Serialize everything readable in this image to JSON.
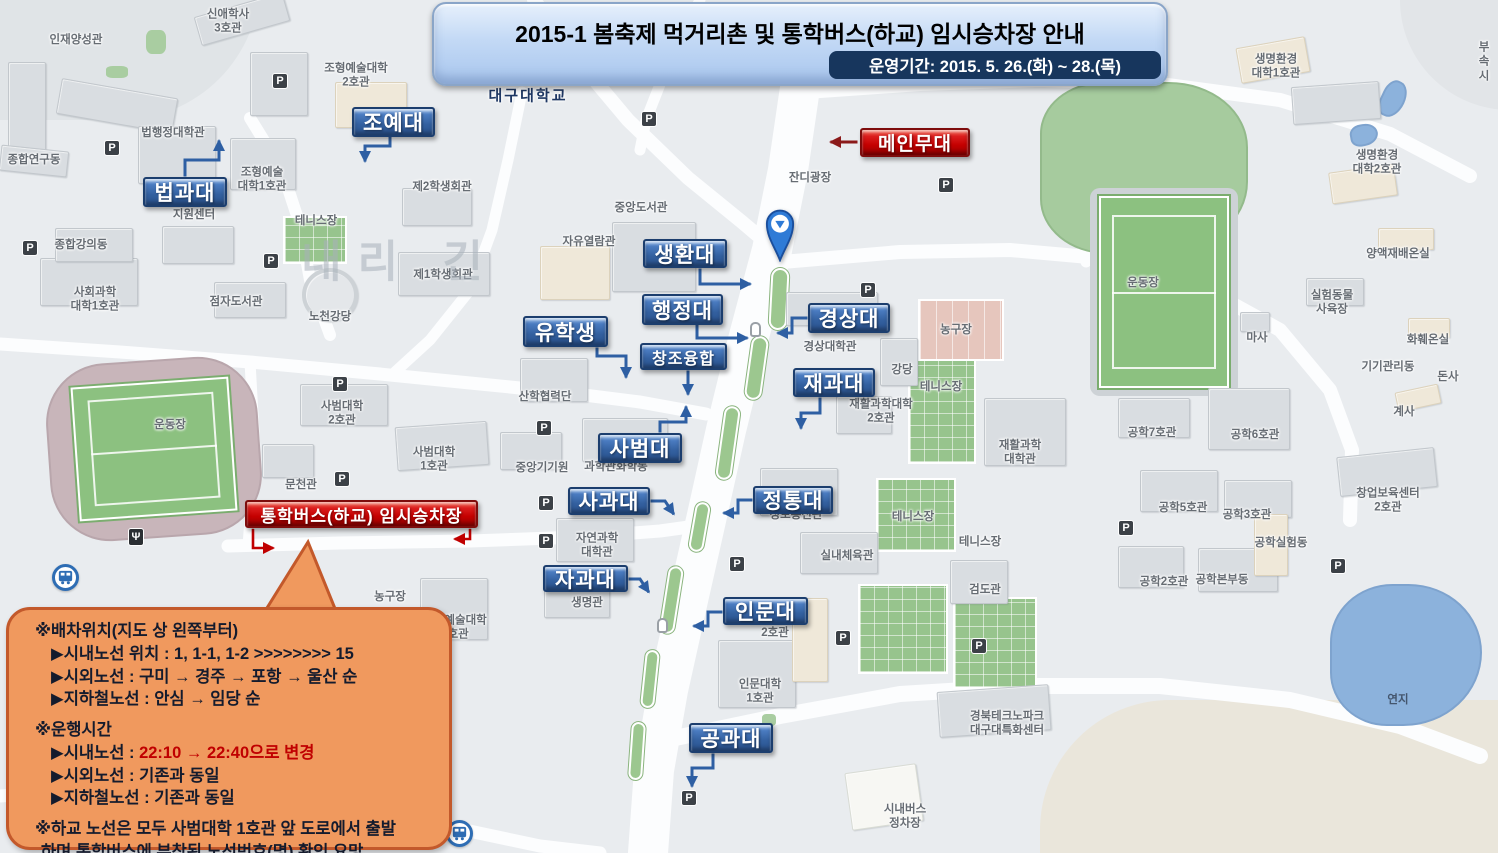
{
  "banner": {
    "title": "2015-1 봄축제 먹거리촌 및 통학버스(하교) 임시승차장 안내",
    "subtitle": "운영기간: 2015. 5. 26.(화) ~ 28.(목)"
  },
  "notice": {
    "lines": [
      {
        "t": "※배차위치(지도 상 왼쪽부터)",
        "ind": 0
      },
      {
        "t": "▶시내노선 위치 : 1, 1-1, 1-2 >>>>>>>> 15",
        "ind": 1
      },
      {
        "t": "▶시외노선 : 구미 → 경주 → 포항 → 울산 순",
        "ind": 1
      },
      {
        "t": "▶지하철노선 : 안심 → 임당 순",
        "ind": 1
      },
      {
        "t": "※운행시간",
        "ind": 0,
        "gap": 1
      },
      {
        "t": "▶시내노선 : ",
        "red": "22:10 → 22:40으로 변경",
        "ind": 1
      },
      {
        "t": "▶시외노선 : 기존과 동일",
        "ind": 1
      },
      {
        "t": "▶지하철노선 : 기존과 동일",
        "ind": 1
      },
      {
        "t": "※하교 노선은 모두 사범대학 1호관 앞 도로에서 출발",
        "ind": 0,
        "gap": 1
      },
      {
        "t": "하며 통학버스에 부착된 노선번호(명) 확인 요망",
        "ind": 2
      }
    ]
  },
  "callouts": [
    {
      "id": "joyedae",
      "text": "조예대",
      "color": "blue",
      "x": 352,
      "y": 107,
      "w": 83,
      "h": 30
    },
    {
      "id": "beopgwadae",
      "text": "법과대",
      "color": "blue",
      "x": 143,
      "y": 177,
      "w": 84,
      "h": 30
    },
    {
      "id": "saenghwandae",
      "text": "생환대",
      "color": "blue",
      "x": 643,
      "y": 239,
      "w": 84,
      "h": 29
    },
    {
      "id": "haengjeongdae",
      "text": "행정대",
      "color": "blue",
      "x": 642,
      "y": 294,
      "w": 81,
      "h": 31
    },
    {
      "id": "yuhaksaeng",
      "text": "유학생",
      "color": "blue",
      "x": 523,
      "y": 316,
      "w": 85,
      "h": 31
    },
    {
      "id": "changjoyunghap",
      "text": "창조융합",
      "color": "blue",
      "x": 640,
      "y": 343,
      "w": 87,
      "h": 27,
      "fs": 16
    },
    {
      "id": "gyeongsangdae",
      "text": "경상대",
      "color": "blue",
      "x": 808,
      "y": 303,
      "w": 82,
      "h": 30
    },
    {
      "id": "jaegwadae",
      "text": "재과대",
      "color": "blue",
      "x": 793,
      "y": 368,
      "w": 82,
      "h": 29
    },
    {
      "id": "sabeomdae",
      "text": "사범대",
      "color": "blue",
      "x": 598,
      "y": 433,
      "w": 84,
      "h": 30
    },
    {
      "id": "sagwadae",
      "text": "사과대",
      "color": "blue",
      "x": 568,
      "y": 487,
      "w": 82,
      "h": 28
    },
    {
      "id": "jeongtongdae",
      "text": "정통대",
      "color": "blue",
      "x": 753,
      "y": 486,
      "w": 80,
      "h": 28
    },
    {
      "id": "jagwadae",
      "text": "자과대",
      "color": "blue",
      "x": 543,
      "y": 565,
      "w": 85,
      "h": 27
    },
    {
      "id": "inmundae",
      "text": "인문대",
      "color": "blue",
      "x": 723,
      "y": 597,
      "w": 85,
      "h": 28
    },
    {
      "id": "gonggwadae",
      "text": "공과대",
      "color": "blue",
      "x": 689,
      "y": 723,
      "w": 84,
      "h": 30
    },
    {
      "id": "main-stage",
      "text": "메인무대",
      "color": "red",
      "x": 860,
      "y": 128,
      "w": 110,
      "h": 29,
      "fs": 19
    },
    {
      "id": "bus-stop",
      "text": "통학버스(하교) 임시승차장",
      "color": "red",
      "x": 245,
      "y": 500,
      "w": 233,
      "h": 28,
      "fs": 17
    }
  ],
  "arrows": [
    {
      "c": "blue",
      "p": "390,138 390,146 365,146 365,160"
    },
    {
      "c": "blue",
      "p": "185,175 185,160 219,160 219,142"
    },
    {
      "c": "blue",
      "p": "700,270 700,284 749,284"
    },
    {
      "c": "blue",
      "p": "697,326 697,338 746,338"
    },
    {
      "c": "blue",
      "p": "597,349 597,356 626,356 626,376"
    },
    {
      "c": "blue",
      "p": "688,372 688,393"
    },
    {
      "c": "blue",
      "p": "806,318 792,318 792,333 779,333"
    },
    {
      "c": "blue",
      "p": "820,399 820,413 801,413 801,427"
    },
    {
      "c": "blue",
      "p": "660,431 660,422 686,422 686,408"
    },
    {
      "c": "blue",
      "p": "652,501 665,501 673,513"
    },
    {
      "c": "blue",
      "p": "751,500 738,500 738,513 725,513"
    },
    {
      "c": "blue",
      "p": "630,579 640,579 648,591"
    },
    {
      "c": "blue",
      "p": "721,612 708,612 708,626 695,626"
    },
    {
      "c": "blue",
      "p": "713,755 713,768 692,768 692,785"
    },
    {
      "c": "darkred",
      "p": "856,142 832,142"
    },
    {
      "c": "red",
      "p": "253,530 253,548 272,548"
    },
    {
      "c": "red",
      "p": "470,530 470,539 456,539"
    }
  ],
  "map": {
    "parking_glyph": "P",
    "food_glyph": "Ψ",
    "terrain": [
      {
        "x": 1040,
        "y": 700,
        "w": 470,
        "h": 160,
        "c": "sand"
      },
      {
        "x": -30,
        "y": -20,
        "w": 290,
        "h": 140,
        "c": "hill"
      },
      {
        "x": 1400,
        "y": -20,
        "w": 110,
        "h": 130,
        "c": "hill2"
      }
    ],
    "roads": [
      {
        "p": "800,88 788,170 772,250 748,340 726,430 706,520 688,600 668,690 654,770 648,853",
        "w": 40
      },
      {
        "p": "534,0 576,58 628,120 688,178 742,222 775,250",
        "w": 14
      },
      {
        "p": "700,0 668,64 646,120 640,150",
        "w": 11
      },
      {
        "p": "522,92 508,160 492,230 470,290 430,340 395,372",
        "w": 11
      },
      {
        "p": "250,118 282,170 300,225 310,280 330,335",
        "w": 12
      },
      {
        "p": "0,344 120,352 250,362 380,374 480,384 560,392 640,402 706,414",
        "w": 13
      },
      {
        "p": "228,546 340,543 470,541 580,537 660,531 696,526",
        "w": 13
      },
      {
        "p": "250,362 255,450 248,546",
        "w": 11
      },
      {
        "p": "782,262 900,252 1010,250 1100,258 1200,286 1280,330 1330,390 1352,450 1350,520",
        "w": 14
      },
      {
        "p": "806,92 920,84 1040,80 1160,84 1280,100 1390,134 1470,176",
        "w": 14
      },
      {
        "p": "1082,86 1078,160 1080,230 1086,262",
        "w": 11
      },
      {
        "p": "0,796 120,788 260,792 370,808 455,828 540,846 600,853",
        "w": 13
      },
      {
        "p": "656,742 780,716 900,694 1030,686 1160,686 1290,700 1400,726 1480,756",
        "w": 16
      }
    ],
    "greens": [
      {
        "k": "lawn",
        "x": 1040,
        "y": 82,
        "w": 208,
        "h": 172
      },
      {
        "k": "fieldwrap",
        "x": 1090,
        "y": 188,
        "w": 148,
        "h": 208
      },
      {
        "k": "field",
        "x": 1099,
        "y": 196,
        "w": 130,
        "h": 192
      },
      {
        "k": "track",
        "x": 48,
        "y": 360,
        "w": 212,
        "h": 178,
        "r": -4
      },
      {
        "k": "field",
        "x": 75,
        "y": 382,
        "w": 158,
        "h": 134,
        "r": -4
      },
      {
        "k": "court",
        "x": 283,
        "y": 216,
        "w": 64,
        "h": 48
      },
      {
        "k": "court",
        "x": 908,
        "y": 352,
        "w": 68,
        "h": 112
      },
      {
        "k": "court",
        "x": 876,
        "y": 478,
        "w": 80,
        "h": 74
      },
      {
        "k": "court",
        "x": 858,
        "y": 584,
        "w": 90,
        "h": 90
      },
      {
        "k": "court",
        "x": 953,
        "y": 597,
        "w": 84,
        "h": 92
      },
      {
        "k": "pink",
        "x": 918,
        "y": 299,
        "w": 86,
        "h": 62
      },
      {
        "k": "median",
        "x": 770,
        "y": 268,
        "w": 18,
        "h": 62,
        "r": 3
      },
      {
        "k": "median",
        "x": 748,
        "y": 336,
        "w": 17,
        "h": 64,
        "r": 8
      },
      {
        "k": "median",
        "x": 720,
        "y": 406,
        "w": 16,
        "h": 74,
        "r": 8
      },
      {
        "k": "median",
        "x": 692,
        "y": 502,
        "w": 15,
        "h": 50,
        "r": 10
      },
      {
        "k": "median",
        "x": 664,
        "y": 566,
        "w": 15,
        "h": 68,
        "r": 9
      },
      {
        "k": "median",
        "x": 643,
        "y": 650,
        "w": 14,
        "h": 58,
        "r": 6
      },
      {
        "k": "median",
        "x": 630,
        "y": 722,
        "w": 14,
        "h": 58,
        "r": 4
      },
      {
        "k": "patch",
        "x": 146,
        "y": 30,
        "w": 20,
        "h": 24
      },
      {
        "k": "patch",
        "x": 106,
        "y": 66,
        "w": 22,
        "h": 12
      },
      {
        "k": "patch",
        "x": 783,
        "y": 650,
        "w": 14,
        "h": 20
      },
      {
        "k": "patch",
        "x": 762,
        "y": 714,
        "w": 14,
        "h": 12
      },
      {
        "k": "pond",
        "x": 1330,
        "y": 584,
        "w": 152,
        "h": 142
      },
      {
        "k": "pond",
        "x": 1381,
        "y": 80,
        "w": 24,
        "h": 38,
        "r": 25
      },
      {
        "k": "pond",
        "x": 1350,
        "y": 124,
        "w": 28,
        "h": 22,
        "r": -10
      }
    ],
    "buildings": [
      {
        "x": 8,
        "y": 62,
        "w": 38,
        "h": 105
      },
      {
        "x": 58,
        "y": 88,
        "w": 118,
        "h": 36,
        "r": 10
      },
      {
        "x": 196,
        "y": 4,
        "w": 92,
        "h": 30,
        "r": -16
      },
      {
        "x": 250,
        "y": 52,
        "w": 58,
        "h": 64
      },
      {
        "x": 335,
        "y": 82,
        "w": 72,
        "h": 46,
        "c": "bg"
      },
      {
        "x": 138,
        "y": 126,
        "w": 78,
        "h": 58
      },
      {
        "x": 0,
        "y": 148,
        "w": 68,
        "h": 26,
        "r": 6
      },
      {
        "x": 40,
        "y": 258,
        "w": 98,
        "h": 48
      },
      {
        "x": 162,
        "y": 226,
        "w": 72,
        "h": 38
      },
      {
        "x": 230,
        "y": 138,
        "w": 66,
        "h": 52
      },
      {
        "x": 214,
        "y": 282,
        "w": 72,
        "h": 36
      },
      {
        "x": 55,
        "y": 228,
        "w": 78,
        "h": 34
      },
      {
        "x": 398,
        "y": 252,
        "w": 92,
        "h": 44
      },
      {
        "x": 302,
        "y": 268,
        "w": 56,
        "h": 54,
        "c": "round"
      },
      {
        "x": 540,
        "y": 246,
        "w": 70,
        "h": 54,
        "c": "bg"
      },
      {
        "x": 612,
        "y": 222,
        "w": 84,
        "h": 70
      },
      {
        "x": 402,
        "y": 188,
        "w": 70,
        "h": 38
      },
      {
        "x": 520,
        "y": 358,
        "w": 68,
        "h": 44
      },
      {
        "x": 500,
        "y": 432,
        "w": 62,
        "h": 38
      },
      {
        "x": 582,
        "y": 418,
        "w": 86,
        "h": 44
      },
      {
        "x": 300,
        "y": 384,
        "w": 88,
        "h": 42
      },
      {
        "x": 396,
        "y": 424,
        "w": 92,
        "h": 44,
        "r": -4
      },
      {
        "x": 262,
        "y": 444,
        "w": 52,
        "h": 34
      },
      {
        "x": 556,
        "y": 518,
        "w": 78,
        "h": 44
      },
      {
        "x": 544,
        "y": 584,
        "w": 66,
        "h": 34
      },
      {
        "x": 420,
        "y": 578,
        "w": 68,
        "h": 62
      },
      {
        "x": 786,
        "y": 292,
        "w": 92,
        "h": 34
      },
      {
        "x": 880,
        "y": 338,
        "w": 38,
        "h": 48
      },
      {
        "x": 836,
        "y": 396,
        "w": 56,
        "h": 38
      },
      {
        "x": 984,
        "y": 398,
        "w": 82,
        "h": 68
      },
      {
        "x": 760,
        "y": 468,
        "w": 78,
        "h": 48
      },
      {
        "x": 800,
        "y": 532,
        "w": 78,
        "h": 42
      },
      {
        "x": 950,
        "y": 560,
        "w": 58,
        "h": 44
      },
      {
        "x": 718,
        "y": 640,
        "w": 78,
        "h": 68
      },
      {
        "x": 792,
        "y": 598,
        "w": 36,
        "h": 84,
        "c": "bg"
      },
      {
        "x": 938,
        "y": 688,
        "w": 112,
        "h": 46,
        "r": -4
      },
      {
        "x": 848,
        "y": 768,
        "w": 72,
        "h": 58,
        "r": -8,
        "c": "wh"
      },
      {
        "x": 1118,
        "y": 398,
        "w": 72,
        "h": 40
      },
      {
        "x": 1208,
        "y": 388,
        "w": 82,
        "h": 62
      },
      {
        "x": 1140,
        "y": 470,
        "w": 78,
        "h": 42
      },
      {
        "x": 1224,
        "y": 480,
        "w": 68,
        "h": 38
      },
      {
        "x": 1338,
        "y": 452,
        "w": 98,
        "h": 40,
        "r": -6
      },
      {
        "x": 1118,
        "y": 546,
        "w": 66,
        "h": 42
      },
      {
        "x": 1198,
        "y": 548,
        "w": 80,
        "h": 44
      },
      {
        "x": 1254,
        "y": 514,
        "w": 34,
        "h": 62,
        "c": "bg"
      },
      {
        "x": 1238,
        "y": 42,
        "w": 70,
        "h": 36,
        "r": -10,
        "c": "bg"
      },
      {
        "x": 1292,
        "y": 84,
        "w": 88,
        "h": 38,
        "r": -4
      },
      {
        "x": 1330,
        "y": 168,
        "w": 66,
        "h": 32,
        "r": -8,
        "c": "bg"
      },
      {
        "x": 1378,
        "y": 228,
        "w": 56,
        "h": 22,
        "c": "bg"
      },
      {
        "x": 1306,
        "y": 278,
        "w": 58,
        "h": 28
      },
      {
        "x": 1408,
        "y": 318,
        "w": 42,
        "h": 20,
        "c": "bg"
      },
      {
        "x": 1396,
        "y": 388,
        "w": 44,
        "h": 20,
        "r": -12,
        "c": "bg"
      },
      {
        "x": 1240,
        "y": 312,
        "w": 30,
        "h": 20
      }
    ],
    "labels": [
      {
        "t": "인재양성관",
        "x": 76,
        "y": 40
      },
      {
        "t": "신애학사\n3호관",
        "x": 228,
        "y": 22
      },
      {
        "t": "조형예술대학\n2호관",
        "x": 356,
        "y": 76
      },
      {
        "t": "대구대학교",
        "x": 528,
        "y": 97,
        "c": "univ"
      },
      {
        "t": "제2학생회관",
        "x": 442,
        "y": 187
      },
      {
        "t": "중앙도서관",
        "x": 641,
        "y": 208
      },
      {
        "t": "자유열람관",
        "x": 589,
        "y": 242
      },
      {
        "t": "잔디광장",
        "x": 810,
        "y": 178
      },
      {
        "t": "종합연구동",
        "x": 34,
        "y": 160
      },
      {
        "t": "법행정대학관",
        "x": 173,
        "y": 133
      },
      {
        "t": "조형예술\n대학1호관",
        "x": 262,
        "y": 180
      },
      {
        "t": "지원센터",
        "x": 194,
        "y": 215
      },
      {
        "t": "테니스장",
        "x": 316,
        "y": 221
      },
      {
        "t": "종합강의동",
        "x": 81,
        "y": 245
      },
      {
        "t": "사회과학\n대학1호관",
        "x": 95,
        "y": 300
      },
      {
        "t": "점자도서관",
        "x": 236,
        "y": 302
      },
      {
        "t": "노천강당",
        "x": 330,
        "y": 317
      },
      {
        "t": "제1학생회관",
        "x": 443,
        "y": 275
      },
      {
        "t": "산학협력단",
        "x": 545,
        "y": 397
      },
      {
        "t": "중앙기기원",
        "x": 542,
        "y": 468
      },
      {
        "t": "과학관화학동",
        "x": 616,
        "y": 467
      },
      {
        "t": "사범대학\n2호관",
        "x": 342,
        "y": 414
      },
      {
        "t": "사범대학\n1호관",
        "x": 434,
        "y": 460
      },
      {
        "t": "문천관",
        "x": 301,
        "y": 485
      },
      {
        "t": "운동장",
        "x": 170,
        "y": 425
      },
      {
        "t": "자연과학\n대학관",
        "x": 597,
        "y": 546
      },
      {
        "t": "생명관",
        "x": 587,
        "y": 603
      },
      {
        "t": "조형예술대학\n5호관",
        "x": 455,
        "y": 628
      },
      {
        "t": "농구장",
        "x": 390,
        "y": 597
      },
      {
        "t": "경상대학관",
        "x": 830,
        "y": 347
      },
      {
        "t": "강당",
        "x": 902,
        "y": 370
      },
      {
        "t": "농구장",
        "x": 956,
        "y": 330
      },
      {
        "t": "테니스장",
        "x": 941,
        "y": 387
      },
      {
        "t": "재활과학대학\n2호관",
        "x": 881,
        "y": 412
      },
      {
        "t": "재활과학\n대학관",
        "x": 1020,
        "y": 453
      },
      {
        "t": "테니스장",
        "x": 913,
        "y": 517
      },
      {
        "t": "테니스장",
        "x": 980,
        "y": 542
      },
      {
        "t": "정보통신관",
        "x": 796,
        "y": 515
      },
      {
        "t": "실내체육관",
        "x": 847,
        "y": 556
      },
      {
        "t": "검도관",
        "x": 985,
        "y": 590
      },
      {
        "t": "인문대학\n1호관",
        "x": 760,
        "y": 692
      },
      {
        "t": "2호관",
        "x": 775,
        "y": 633
      },
      {
        "t": "경북테크노파크\n대구대특화센터",
        "x": 1007,
        "y": 724
      },
      {
        "t": "시내버스\n정차장",
        "x": 905,
        "y": 817
      },
      {
        "t": "공학7호관",
        "x": 1152,
        "y": 433
      },
      {
        "t": "공학6호관",
        "x": 1255,
        "y": 435
      },
      {
        "t": "공학5호관",
        "x": 1183,
        "y": 508
      },
      {
        "t": "공학3호관",
        "x": 1247,
        "y": 515
      },
      {
        "t": "창업보육센터\n2호관",
        "x": 1388,
        "y": 501
      },
      {
        "t": "공학실험동",
        "x": 1281,
        "y": 543
      },
      {
        "t": "공학2호관",
        "x": 1164,
        "y": 582
      },
      {
        "t": "공학본부동",
        "x": 1222,
        "y": 580
      },
      {
        "t": "계사",
        "x": 1404,
        "y": 412
      },
      {
        "t": "돈사",
        "x": 1448,
        "y": 377
      },
      {
        "t": "기기관리동",
        "x": 1388,
        "y": 367
      },
      {
        "t": "화훼온실",
        "x": 1428,
        "y": 340
      },
      {
        "t": "마사",
        "x": 1257,
        "y": 338
      },
      {
        "t": "실험동물\n사육장",
        "x": 1332,
        "y": 303
      },
      {
        "t": "양액재배온실",
        "x": 1398,
        "y": 254
      },
      {
        "t": "생명환경\n대학1호관",
        "x": 1276,
        "y": 67
      },
      {
        "t": "생명환경\n대학2호관",
        "x": 1377,
        "y": 163
      },
      {
        "t": "운동장",
        "x": 1143,
        "y": 283
      },
      {
        "t": "연지",
        "x": 1398,
        "y": 700,
        "c": "pond-label"
      },
      {
        "t": "부속\n시",
        "x": 1484,
        "y": 62
      },
      {
        "t": "내리 긴",
        "x": 400,
        "y": 262,
        "c": "wm"
      }
    ],
    "picons": [
      [
        272,
        73
      ],
      [
        104,
        140
      ],
      [
        22,
        240
      ],
      [
        263,
        253
      ],
      [
        641,
        111
      ],
      [
        860,
        282
      ],
      [
        938,
        177
      ],
      [
        536,
        420
      ],
      [
        538,
        495
      ],
      [
        538,
        533
      ],
      [
        332,
        376
      ],
      [
        334,
        471
      ],
      [
        729,
        556
      ],
      [
        681,
        790
      ],
      [
        835,
        630
      ],
      [
        971,
        638
      ],
      [
        1118,
        520
      ],
      [
        1330,
        558
      ]
    ]
  }
}
